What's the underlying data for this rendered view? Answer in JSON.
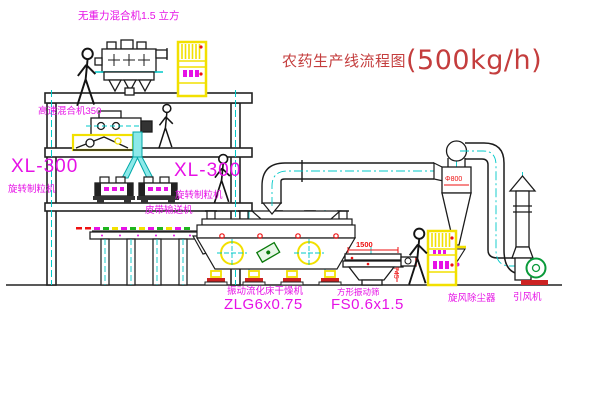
{
  "title": {
    "main": "农药生产线流程图",
    "capacity": "(500kg/h)"
  },
  "labels": {
    "gravity_mixer": "无重力混合机1.5 立方",
    "high_speed_mixer": "高速混合机350",
    "granulator_left_model": "XL-300",
    "granulator_left_name": "旋转制粒机",
    "granulator_right_model": "XL-300",
    "granulator_right_name": "旋转制粒机",
    "belt_conveyor": "皮带输送机",
    "dryer_name": "振动流化床干燥机",
    "dryer_model": "ZLG6x0.75",
    "sieve_name": "方形振动筛",
    "sieve_model": "FS0.6x1.5",
    "cyclone": "旋风除尘器",
    "fan": "引风机"
  },
  "dimensions": {
    "sieve_length": "1500",
    "cyclone_diameter": "Φ800",
    "sieve_height": "745"
  },
  "colors": {
    "line": "#1b1b1b",
    "centerline": "#00c8c8",
    "equipment_highlight": "#f2e000",
    "label_magenta": "#e611e6",
    "title_red": "#c43d3d",
    "dimension_red": "#ee1111",
    "fan_green": "#0a9a3a",
    "foot_pad_red": "#cc2222",
    "chute_cyan": "#8ce9e9"
  }
}
